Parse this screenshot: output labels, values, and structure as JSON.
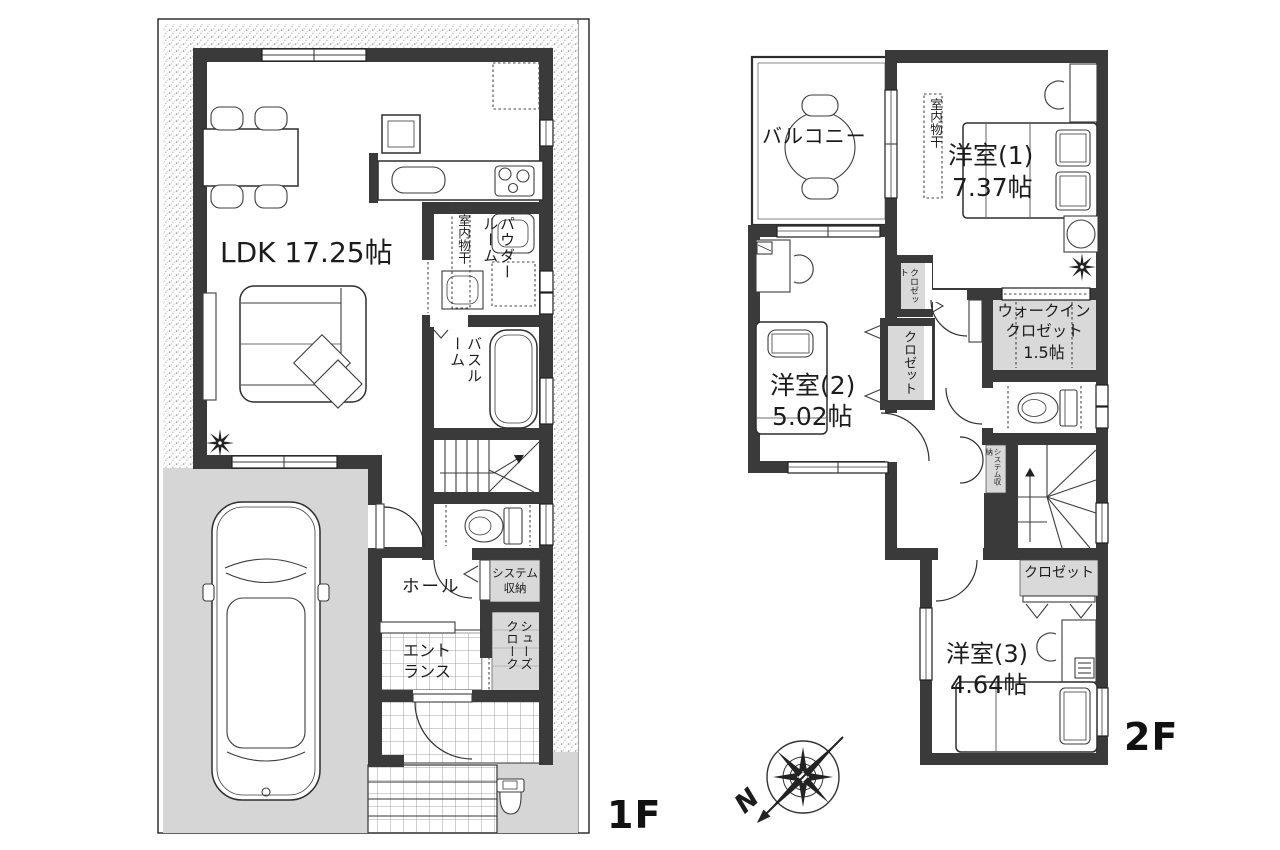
{
  "colors": {
    "wall": "#3a3a3a",
    "closet": "#d9d9d9",
    "ground": "#d6d6d6"
  },
  "floor1": {
    "floor_label": "1F",
    "ldk": "LDK 17.25帖",
    "powder_room": "パウダールーム",
    "indoor_drying": "室内物干",
    "bathroom": "バスルーム",
    "hall": "ホール",
    "system_storage": "システム収納",
    "entrance": "エントランス",
    "shoes_cloak": "シューズクローク"
  },
  "floor2": {
    "floor_label": "2F",
    "balcony": "バルコニー",
    "indoor_drying": "室内物干",
    "room1": "洋室(1)",
    "room1_size": "7.37帖",
    "closet_upper": "クロゼット",
    "closet_mid": "クロゼット",
    "wic_line1": "ウォークイン",
    "wic_line2": "クロゼット",
    "wic_size": "1.5帖",
    "room2": "洋室(2)",
    "room2_size": "5.02帖",
    "system_storage": "システム収納",
    "closet_lower": "クロゼット",
    "room3": "洋室(3)",
    "room3_size": "4.64帖"
  },
  "compass": {
    "north": "N"
  }
}
